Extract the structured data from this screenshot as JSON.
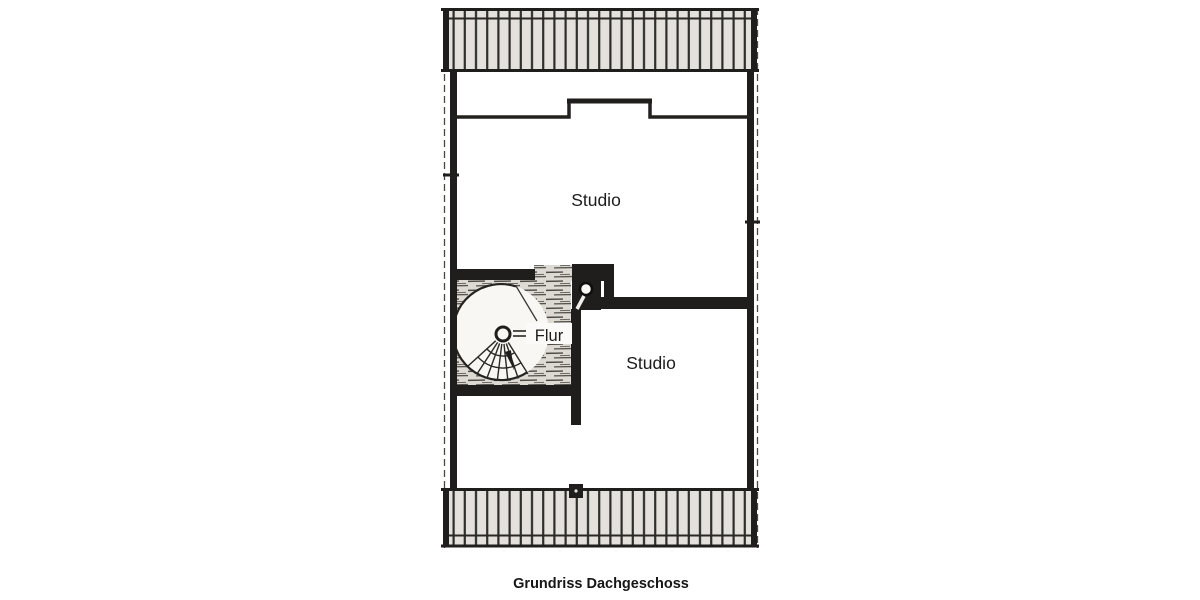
{
  "caption": "Grundriss Dachgeschoss",
  "rooms": [
    {
      "id": "studio-upper",
      "label": "Studio"
    },
    {
      "id": "flur",
      "label": "Flur"
    },
    {
      "id": "studio-lower",
      "label": "Studio"
    }
  ],
  "symbols": {
    "spiral_stair": "spiral-staircase",
    "shaft": "shaft-block",
    "roof_hatch_top": "roof-overhang-hatch-top",
    "roof_hatch_bottom": "roof-overhang-hatch-bottom"
  },
  "colors": {
    "ink": "#1f1e1c",
    "paper": "#ffffff",
    "hatch_fill": "#e4e1dc",
    "hatch_line": "#35332f",
    "scribble_fill": "#ddd9d3",
    "scribble_line": "#4d4a45"
  }
}
